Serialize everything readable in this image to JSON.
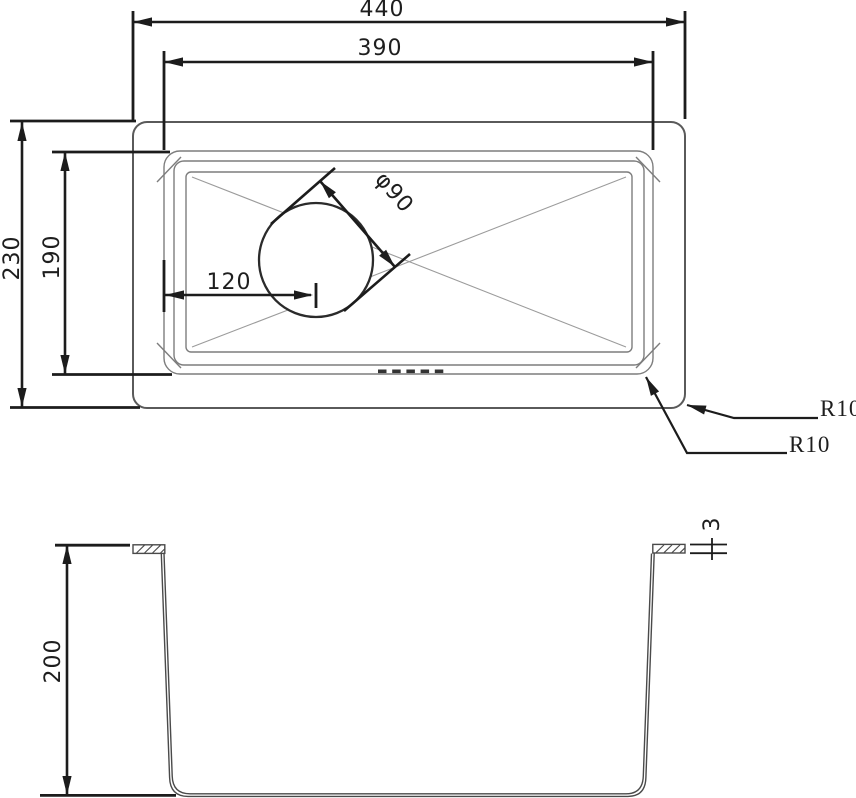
{
  "drawing": {
    "kind": "sink-technical-drawing",
    "views": {
      "top": {
        "dim_width_outer": "440",
        "dim_width_inner": "390",
        "dim_depth_outer": "230",
        "dim_depth_inner": "190",
        "dim_drain_offset": "120",
        "dim_drain_diameter": "φ90",
        "dim_corner_radius_outer": "R10",
        "dim_corner_radius_inner": "R10"
      },
      "section": {
        "dim_bowl_depth": "200",
        "dim_material_thickness": "3"
      }
    },
    "colors": {
      "background": "#ffffff",
      "dimension": "#1c1c1c",
      "outline_medium": "#5a5a5a",
      "outline_thin": "#7d7d7d",
      "diagonal_thin": "#9b9b9b"
    }
  }
}
